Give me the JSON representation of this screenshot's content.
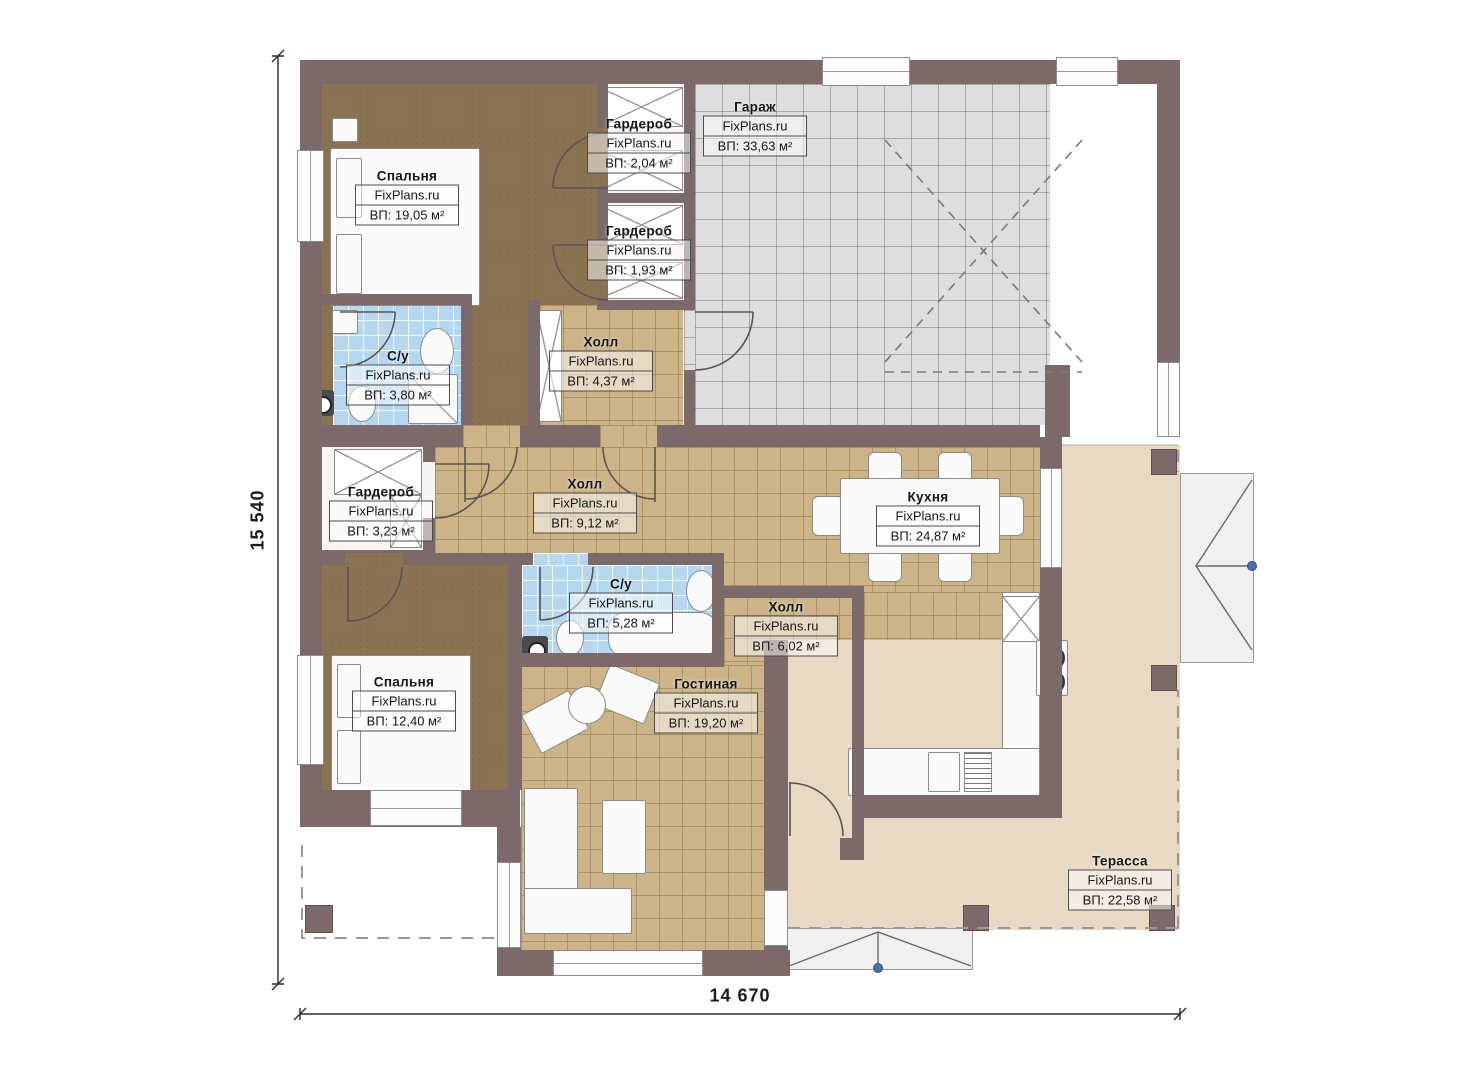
{
  "title": "Floor plan with room areas",
  "watermark": "FixPlans.ru",
  "dimensions": {
    "height_label": "15 540",
    "width_label": "14 670"
  },
  "rooms": [
    {
      "id": "bedroom-1",
      "name": "Спальня",
      "area": "ВП: 19,05 м²"
    },
    {
      "id": "wardrobe-1",
      "name": "Гардероб",
      "area": "ВП: 2,04 м²"
    },
    {
      "id": "garage",
      "name": "Гараж",
      "area": "ВП: 33,63 м²"
    },
    {
      "id": "wardrobe-2",
      "name": "Гардероб",
      "area": "ВП: 1,93 м²"
    },
    {
      "id": "bathroom-1",
      "name": "С/у",
      "area": "ВП: 3,80 м²"
    },
    {
      "id": "hall-1",
      "name": "Холл",
      "area": "ВП: 4,37 м²"
    },
    {
      "id": "wardrobe-3",
      "name": "Гардероб",
      "area": "ВП: 3,23 м²"
    },
    {
      "id": "hall-2",
      "name": "Холл",
      "area": "ВП: 9,12 м²"
    },
    {
      "id": "kitchen",
      "name": "Кухня",
      "area": "ВП: 24,87 м²"
    },
    {
      "id": "bathroom-2",
      "name": "С/у",
      "area": "ВП: 5,28 м²"
    },
    {
      "id": "hall-3",
      "name": "Холл",
      "area": "ВП: 6,02 м²"
    },
    {
      "id": "bedroom-2",
      "name": "Спальня",
      "area": "ВП: 12,40 м²"
    },
    {
      "id": "living-room",
      "name": "Гостиная",
      "area": "ВП: 19,20 м²"
    },
    {
      "id": "terrace",
      "name": "Терасса",
      "area": "ВП: 22,58 м²"
    }
  ],
  "colors": {
    "wall": "#7c6a6a",
    "floor_tile_tan": "#cdb488",
    "floor_bathroom_blue": "#b5d7f0",
    "floor_garage_gray": "#dedede",
    "floor_bedroom_brown": "#8a7352",
    "floor_terrace_beige": "#e8d9c5",
    "door_marker_blue": "#4a6fae"
  }
}
